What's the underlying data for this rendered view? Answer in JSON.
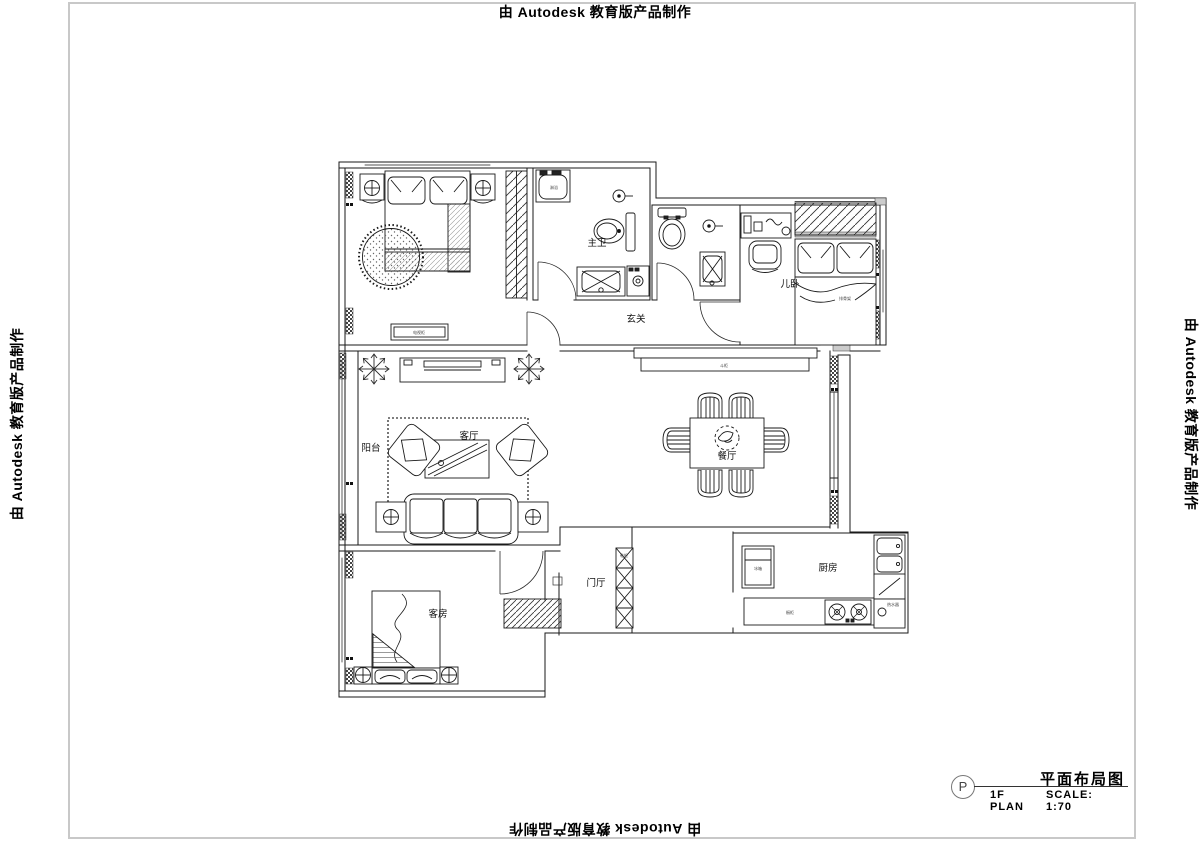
{
  "watermark": {
    "text": "由 Autodesk 教育版产品制作"
  },
  "title_block": {
    "marker": "P",
    "title": "平面布局图",
    "plan": "1F PLAN",
    "scale": "SCALE: 1:70"
  },
  "rooms": {
    "master_bath": "主卫",
    "hallway": "玄关",
    "kids_room": "儿卧",
    "balcony": "阳台",
    "living": "客厅",
    "dining": "餐厅",
    "foyer": "门厅",
    "kitchen": "厨房",
    "guest": "客房"
  },
  "furniture": {
    "tv_cabinet": "电视柜",
    "shower": "淋浴",
    "fridge": "冰箱",
    "counter": "橱柜",
    "bed_slats": "排骨架",
    "shoe_cabinet": "鞋柜",
    "console": "斗柜",
    "water_heater": "热水器"
  },
  "colors": {
    "line": "#1a1a1a",
    "frame": "#c8c8c8",
    "wall_fill": "#cccccc"
  }
}
